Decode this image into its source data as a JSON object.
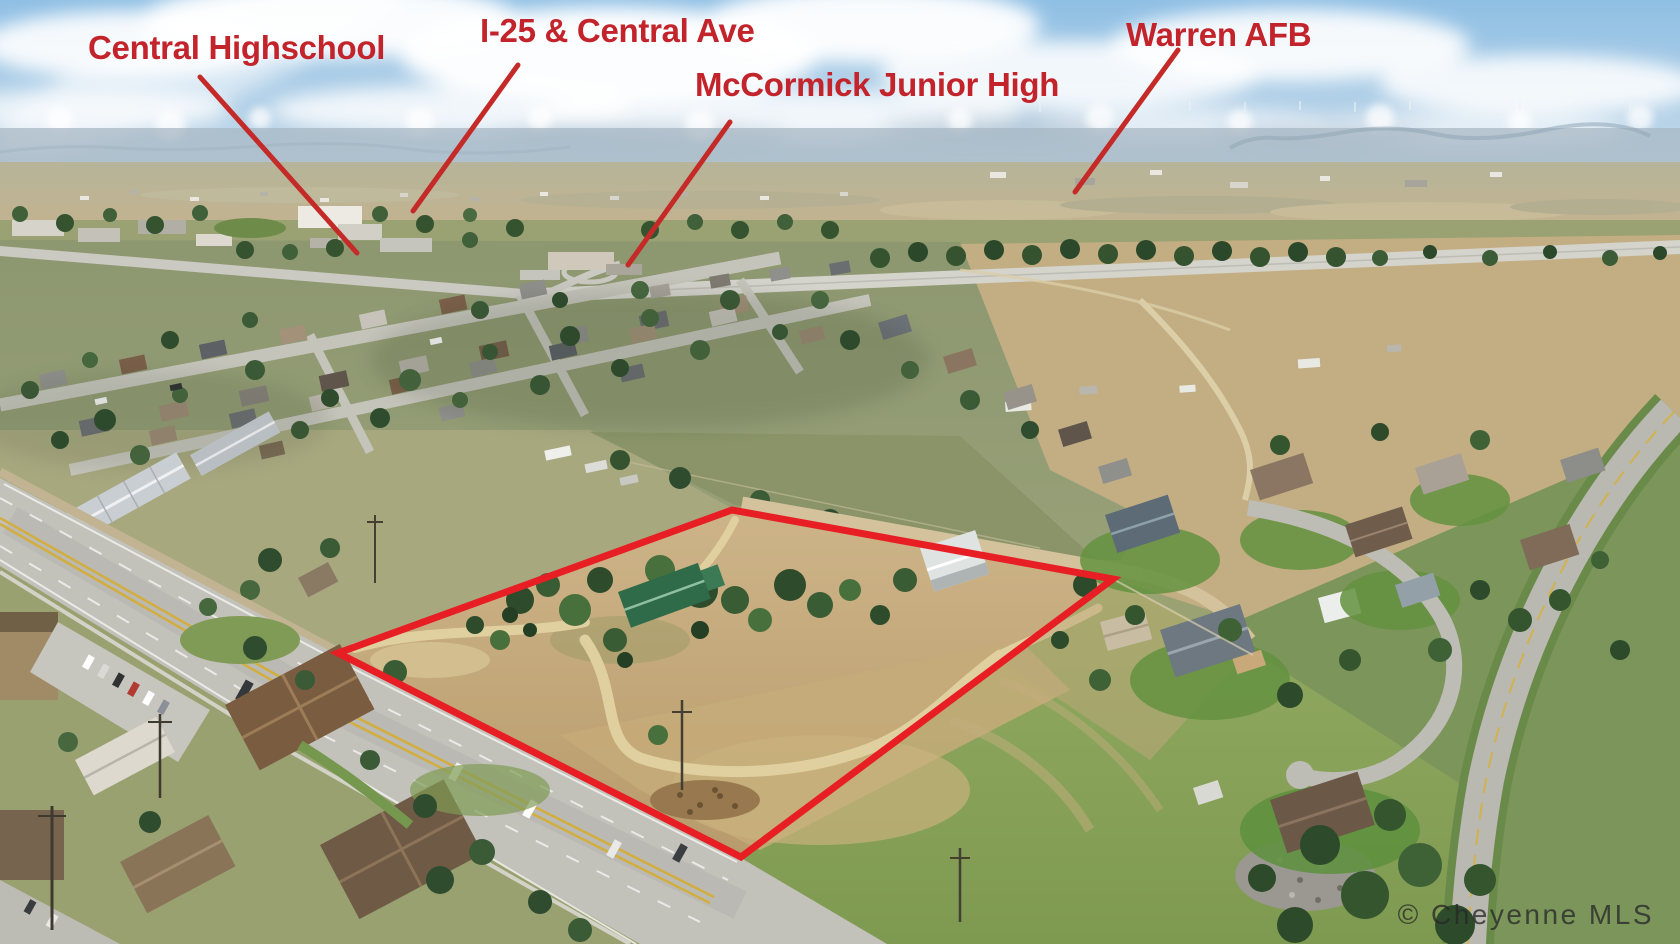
{
  "annotations": {
    "labels": [
      {
        "id": "central-highschool",
        "text": "Central Highschool"
      },
      {
        "id": "i25-central-ave",
        "text": "I-25 & Central Ave"
      },
      {
        "id": "mccormick-junior-high",
        "text": "McCormick Junior High"
      },
      {
        "id": "warren-afb",
        "text": "Warren AFB"
      }
    ],
    "pointer_lines": [
      {
        "for": "Central Highschool",
        "points": "200,77 357,253"
      },
      {
        "for": "I-25 & Central Ave",
        "points": "518,65 413,211"
      },
      {
        "for": "McCormick Junior High",
        "points": "730,122 628,265"
      },
      {
        "for": "Warren AFB",
        "points": "1178,50 1075,192"
      }
    ],
    "property_boundary": {
      "points": "338,653 732,510 1113,579 741,857"
    }
  },
  "watermark": {
    "text": "© Cheyenne MLS"
  },
  "colors": {
    "label_red": "#c3242c",
    "line_red": "#c42a28",
    "boundary_red": "#e81e25",
    "watermark_gray": "rgba(40,40,40,0.78)"
  }
}
